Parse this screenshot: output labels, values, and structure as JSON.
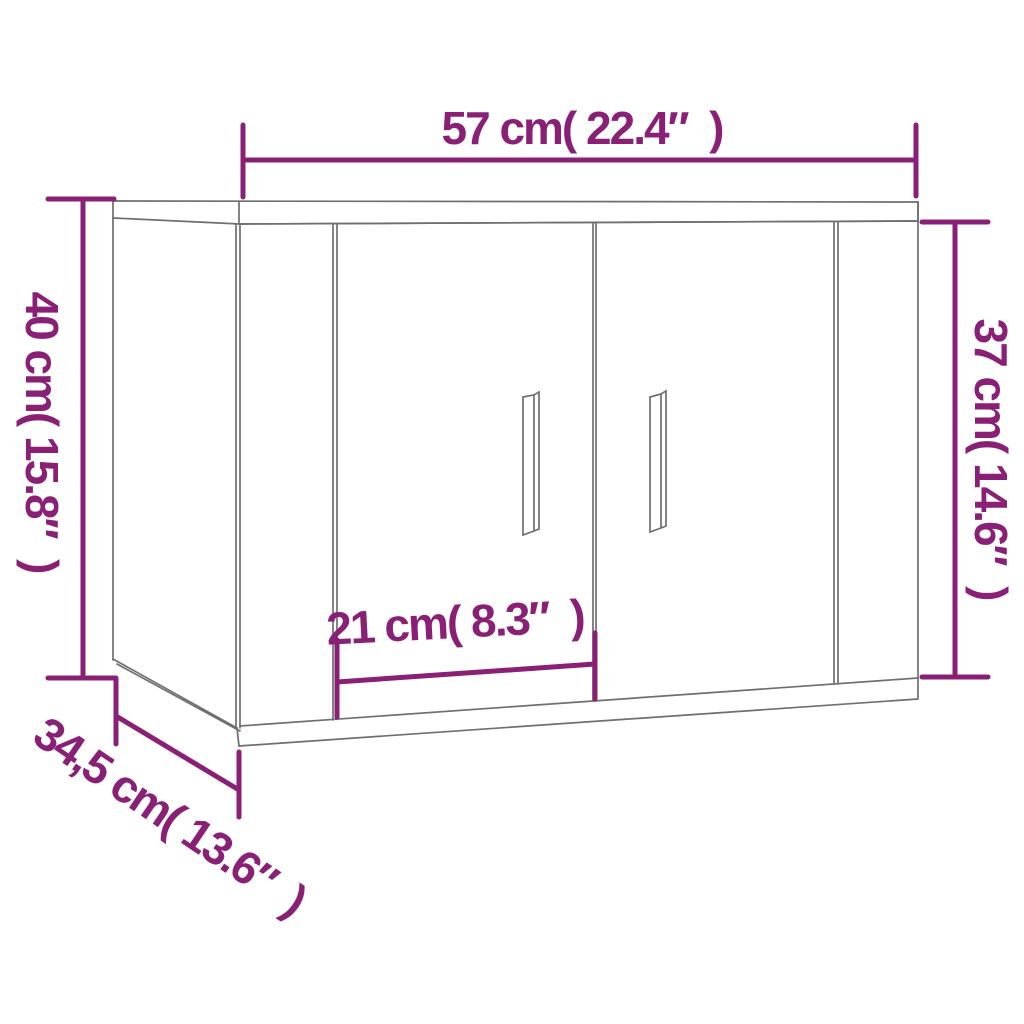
{
  "diagram": {
    "subject": "wall-mounted two-door cabinet line drawing with dimension annotations",
    "colors": {
      "background": "#ffffff",
      "outline_gray": "#6f6f6f",
      "dimension_purple": "#8a1f76"
    },
    "dimensions": {
      "width": {
        "cm": "57",
        "inch": "22.4",
        "label": "57 cm( 22.4″  )"
      },
      "height_overall": {
        "cm": "40",
        "inch": "15.8",
        "label": "40 cm( 15.8″  )"
      },
      "height_front": {
        "cm": "37",
        "inch": "14.6",
        "label": "37 cm( 14.6″  )"
      },
      "door_width": {
        "cm": "21",
        "inch": "8.3",
        "label": "21 cm( 8.3″  )"
      },
      "depth": {
        "cm": "34,5",
        "inch": "13.6",
        "label": "34,5 cm( 13.6″  )"
      }
    }
  }
}
